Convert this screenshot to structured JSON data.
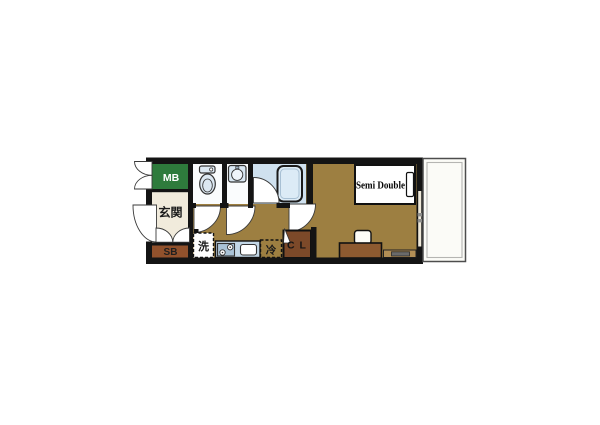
{
  "floorplan": {
    "labels": {
      "meter_box": "MB",
      "entrance": "玄関",
      "shoe_box": "SB",
      "washer": "洗",
      "refrigerator": "冷",
      "closet": "C L",
      "bed": "Semi Double"
    },
    "colors": {
      "wall": "#141414",
      "floor": "#9d7f41",
      "meter_box": "#2e7b3c",
      "entrance_floor": "#f1ebdc",
      "shoe_box": "#91512c",
      "closet": "#7c4929",
      "bathroom_floor": "#cfe1ef",
      "fixture_blue": "#dce8f2",
      "kitchen_counter": "#c3d7e6",
      "desk": "#8d5a30",
      "tv_board": "#b28e55",
      "balcony": "#fbfbf7"
    }
  }
}
